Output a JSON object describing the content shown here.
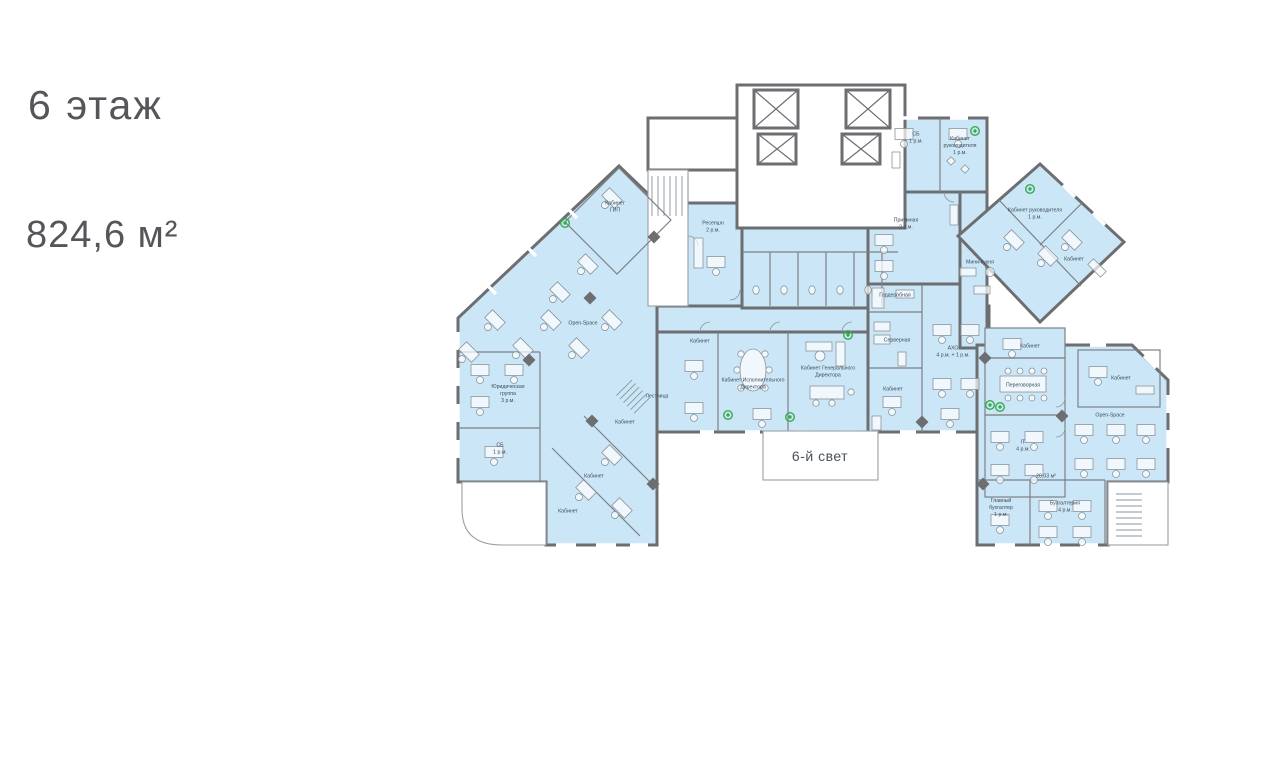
{
  "header": {
    "floor": "6 этаж",
    "area": "824,6 м²"
  },
  "plan": {
    "light_well_label": "6-й свет",
    "colors": {
      "room_fill": "#cbe7f7",
      "wall": "#6d6e71",
      "label_text": "#3e4a57",
      "plant": "#3aaa4f",
      "heading_text": "#54565a"
    },
    "rooms": [
      {
        "text": "Кабинет\nГИП",
        "x": 615,
        "y": 207
      },
      {
        "text": "Open-Space",
        "x": 583,
        "y": 324
      },
      {
        "text": "Юридическая\nгруппа\n3 р.м.",
        "x": 508,
        "y": 394
      },
      {
        "text": "СБ\n1 р.м.",
        "x": 500,
        "y": 449
      },
      {
        "text": "Кабинет",
        "x": 625,
        "y": 423
      },
      {
        "text": "Кабинет",
        "x": 594,
        "y": 477
      },
      {
        "text": "Кабинет",
        "x": 568,
        "y": 512
      },
      {
        "text": "Лестница",
        "x": 657,
        "y": 397
      },
      {
        "text": "Ресепшн\n2 р.м.",
        "x": 713,
        "y": 227
      },
      {
        "text": "Кабинет",
        "x": 700,
        "y": 342
      },
      {
        "text": "Кабинет Исполнительного\nДиректора",
        "x": 753,
        "y": 384
      },
      {
        "text": "Кабинет Генерального\nДиректора",
        "x": 828,
        "y": 372
      },
      {
        "text": "Гардеробная",
        "x": 895,
        "y": 296
      },
      {
        "text": "Серверная",
        "x": 897,
        "y": 341
      },
      {
        "text": "Кабинет",
        "x": 893,
        "y": 390
      },
      {
        "text": "АХО\n4 р.м. + 1 р.м.",
        "x": 953,
        "y": 352
      },
      {
        "text": "Приемная\n2 р.м.",
        "x": 906,
        "y": 224
      },
      {
        "text": "СБ\n1 р.м.",
        "x": 916,
        "y": 138
      },
      {
        "text": "Кабинет\nруководителя\n1 р.м.",
        "x": 960,
        "y": 146
      },
      {
        "text": "Кабинет руководителя\n1 р.м.",
        "x": 1035,
        "y": 214
      },
      {
        "text": "Мини-кухня",
        "x": 980,
        "y": 263
      },
      {
        "text": "Кабинет",
        "x": 1074,
        "y": 260
      },
      {
        "text": "Кабинет",
        "x": 1030,
        "y": 347
      },
      {
        "text": "Переговорная",
        "x": 1023,
        "y": 386
      },
      {
        "text": "Кабинет",
        "x": 1121,
        "y": 379
      },
      {
        "text": "Open-Space",
        "x": 1110,
        "y": 416
      },
      {
        "text": "IT\n4 р.м.",
        "x": 1023,
        "y": 446
      },
      {
        "text": "20,03 м²",
        "x": 1046,
        "y": 477
      },
      {
        "text": "Главный\nбухгалтер\n1 р.м.",
        "x": 1001,
        "y": 508
      },
      {
        "text": "Бухгалтерия\n4 р.м.",
        "x": 1065,
        "y": 507
      }
    ]
  }
}
